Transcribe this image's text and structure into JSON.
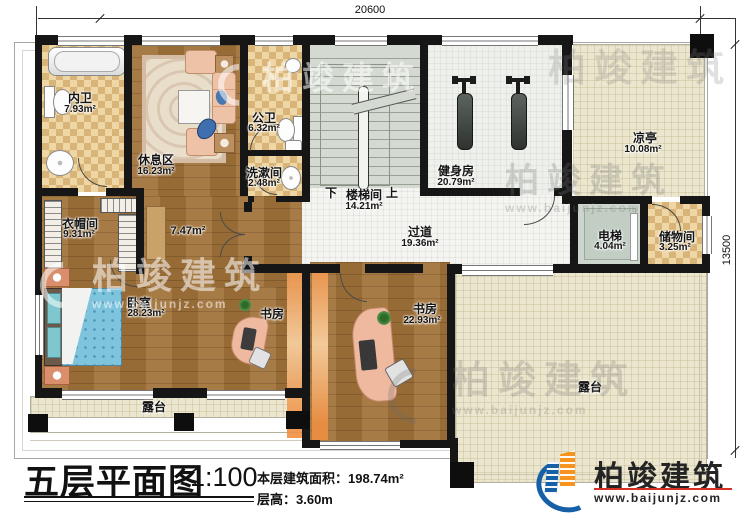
{
  "plan": {
    "dimensions": {
      "width_mm": "20600",
      "height_mm": "13500"
    },
    "rooms": {
      "neiwei": {
        "name": "内卫",
        "area": "7.93m²"
      },
      "xiuxiqu": {
        "name": "休息区",
        "area": "16.23m²"
      },
      "gongwei": {
        "name": "公卫",
        "area": "6.32m²"
      },
      "xishujian": {
        "name": "洗漱间",
        "area": "2.48m²"
      },
      "loutijian": {
        "name": "楼梯间",
        "area": "14.21m²",
        "down_label": "下",
        "up_label": "上"
      },
      "jianshenfang": {
        "name": "健身房",
        "area": "20.79m²"
      },
      "liangting": {
        "name": "凉亭",
        "area": "10.08m²"
      },
      "dianti": {
        "name": "电梯",
        "area": "4.04m²"
      },
      "chuwujian": {
        "name": "储物间",
        "area": "3.25m²"
      },
      "guodao": {
        "name": "过道",
        "area": "19.36m²"
      },
      "yimaojian": {
        "name": "衣帽间",
        "area": "9.31m²"
      },
      "passage": {
        "area": "7.47m²"
      },
      "woshi": {
        "name": "卧室",
        "area": "28.23m²"
      },
      "shufang_small": {
        "name": "书房"
      },
      "shufang_large": {
        "name": "书房",
        "area": "22.93m²"
      },
      "lutai_left": {
        "name": "露台"
      },
      "lutai_right": {
        "name": "露台"
      }
    }
  },
  "title_block": {
    "title": "五层平面图",
    "scale": "1:100",
    "floor_area": "本层建筑面积：198.74m²",
    "floor_height": "层高：3.60m"
  },
  "branding": {
    "company": "柏竣建筑",
    "website": "www.baijunjz.com"
  },
  "watermark": {
    "company": "柏竣建筑",
    "website": "www.baijunjz.com"
  },
  "colors": {
    "wall": "#161616",
    "wood_floor": "#a2733a",
    "tile_checker_light": "#eed7a4",
    "tile_checker_dark": "#d8b478",
    "terrace": "#ebe6cd",
    "logo_blue": "#1660a8",
    "logo_orange": "#f7941d",
    "url_line_red": "#d93025"
  }
}
